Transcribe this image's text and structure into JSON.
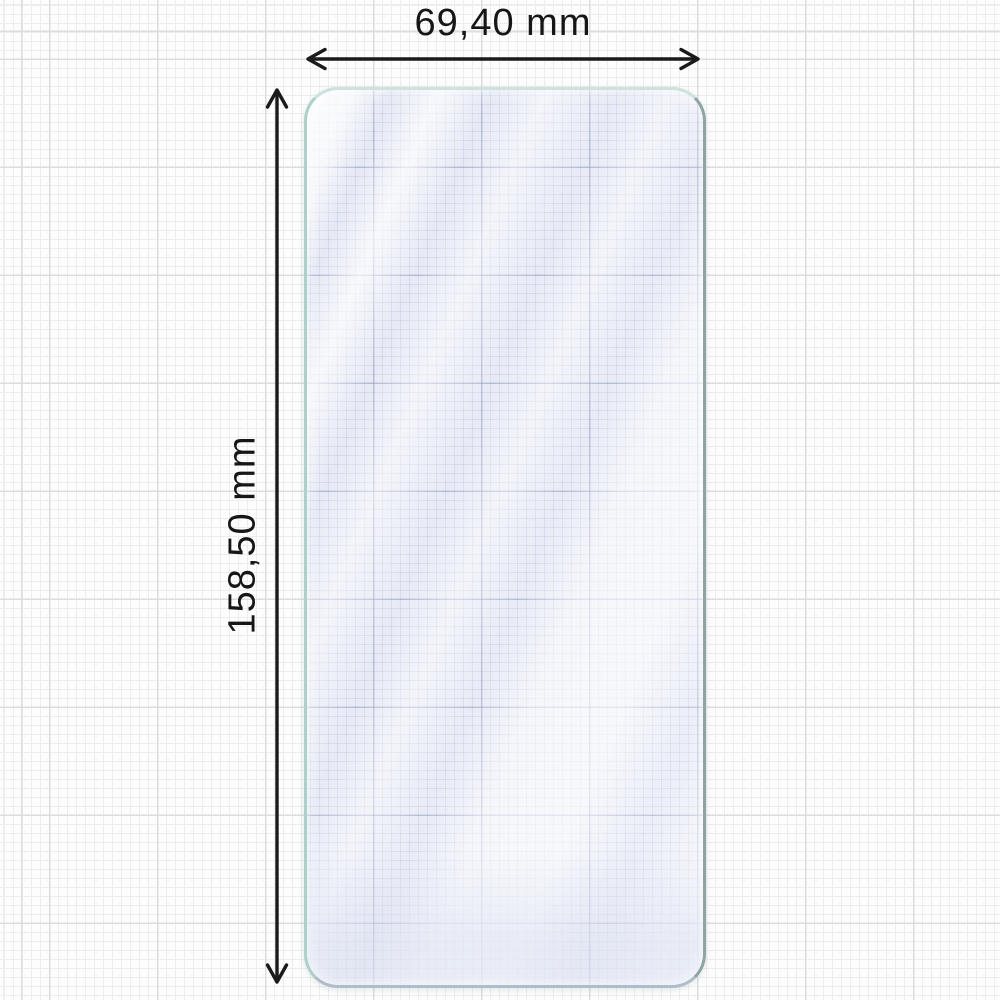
{
  "diagram": {
    "item": "screen-protector-film",
    "width_label": "69,40 mm",
    "height_label": "158,50 mm"
  },
  "colors": {
    "arrow": "#1a1a1a",
    "text": "#161616",
    "protector_tint": "#e7eaf5",
    "edge_left": "#aed0cb",
    "edge_top": "#cfe1dd",
    "edge_right": "#8fa5a3",
    "edge_bottom": "#afbcca",
    "grid_minor": "#ededed",
    "grid_major": "#dddddd"
  }
}
